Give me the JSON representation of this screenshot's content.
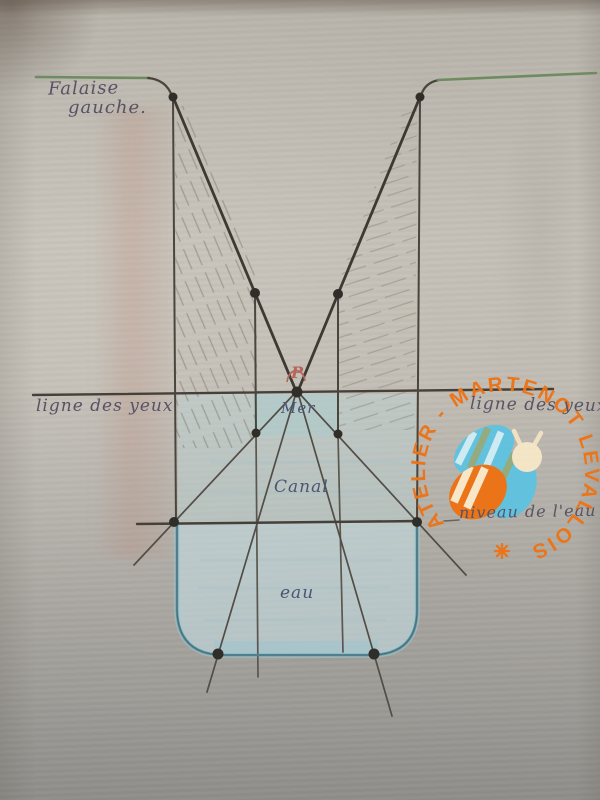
{
  "document": {
    "kind": "hand-drawn perspective construction study on paper",
    "language": "fr"
  },
  "labels": {
    "falaise_line1": "Falaise",
    "falaise_line2": "gauche.",
    "ligne_des_yeux_left": "ligne des yeux",
    "ligne_des_yeux_right": "ligne des yeux",
    "point_label": "P",
    "mer": "Mer",
    "canal": "Canal",
    "eau": "eau",
    "niveau": "niveau de l'eau"
  },
  "watermark": {
    "arc_text": "ATELIER - MARTENOT LEVALLOIS",
    "symbol": "asterisk",
    "accent_color": "#ee7315"
  },
  "colors": {
    "paper": "#bfbbb2",
    "pencil": "#47423b",
    "cliff_top_green": "#6e8c5f",
    "water_outline_blue": "#4f93a6",
    "water_fill_blue": "#c4dade",
    "cliff_wash_red": "#ba8270",
    "vanishing_point_red": "#b5675a",
    "bee_blue": "#5fc3e1",
    "bee_orange": "#ee7214",
    "bee_cream": "#f6e7c8"
  }
}
